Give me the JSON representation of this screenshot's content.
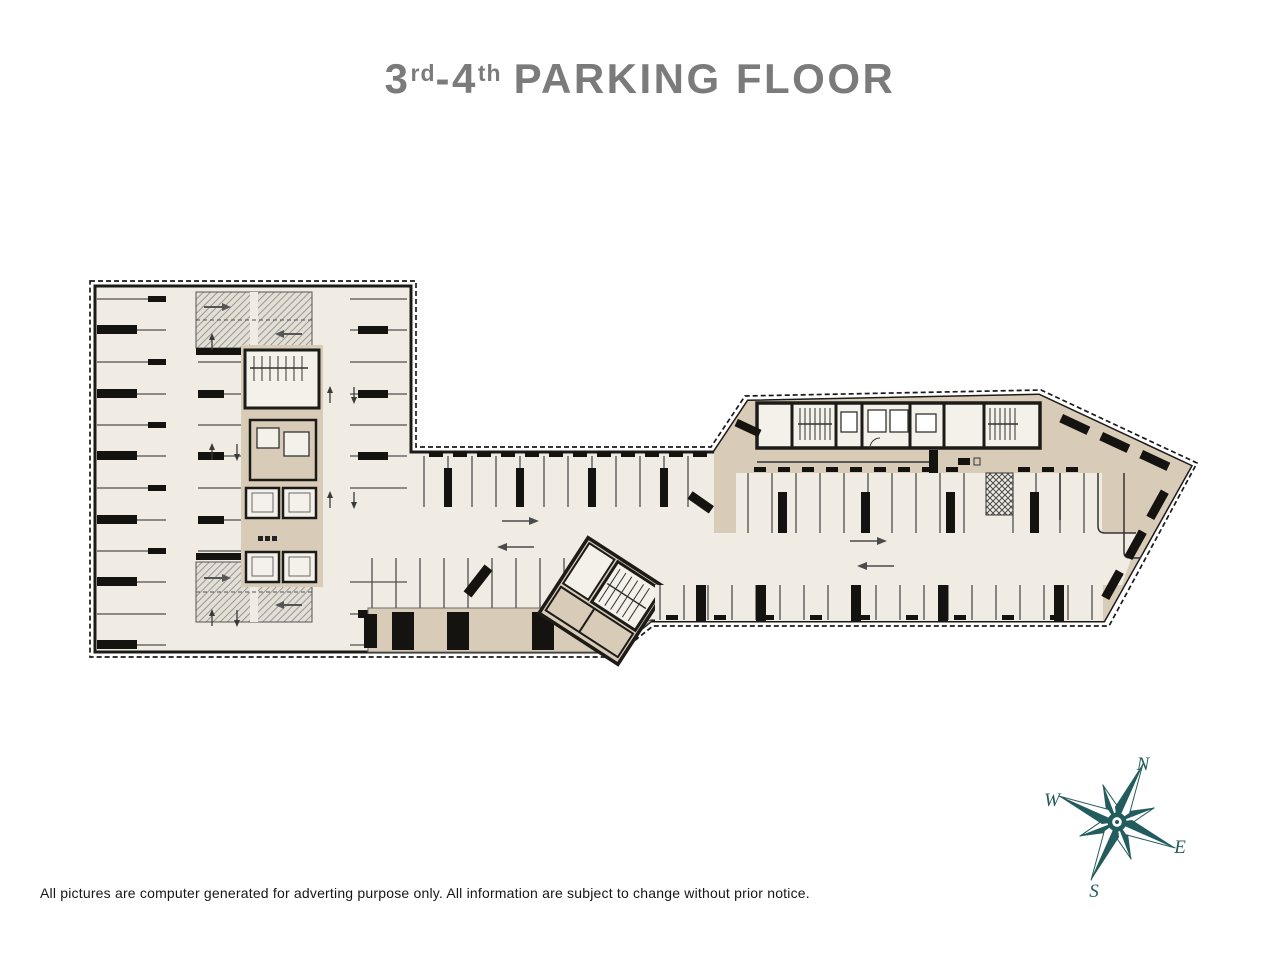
{
  "title": {
    "floor_start": "3",
    "floor_start_suffix": "rd",
    "separator": "-",
    "floor_end": "4",
    "floor_end_suffix": "th",
    "label": "PARKING FLOOR",
    "color": "#7b7b7b"
  },
  "plan": {
    "type": "parking-floor-plan",
    "colors": {
      "floor": "#f0ece3",
      "core_tan": "#d8ccb8",
      "room_white": "#f4f1ea",
      "wall": "#1d1b18",
      "stall_line": "#4f4f4f",
      "ramp_hatch_bg": "#e3dfd5",
      "ramp_hatch_line": "#868686"
    }
  },
  "compass": {
    "north": "N",
    "east": "E",
    "south": "S",
    "west": "W",
    "color": "#235c5c"
  },
  "footer": {
    "disclaimer": "All pictures are computer generated for adverting purpose only. All information are subject to change without prior notice."
  }
}
